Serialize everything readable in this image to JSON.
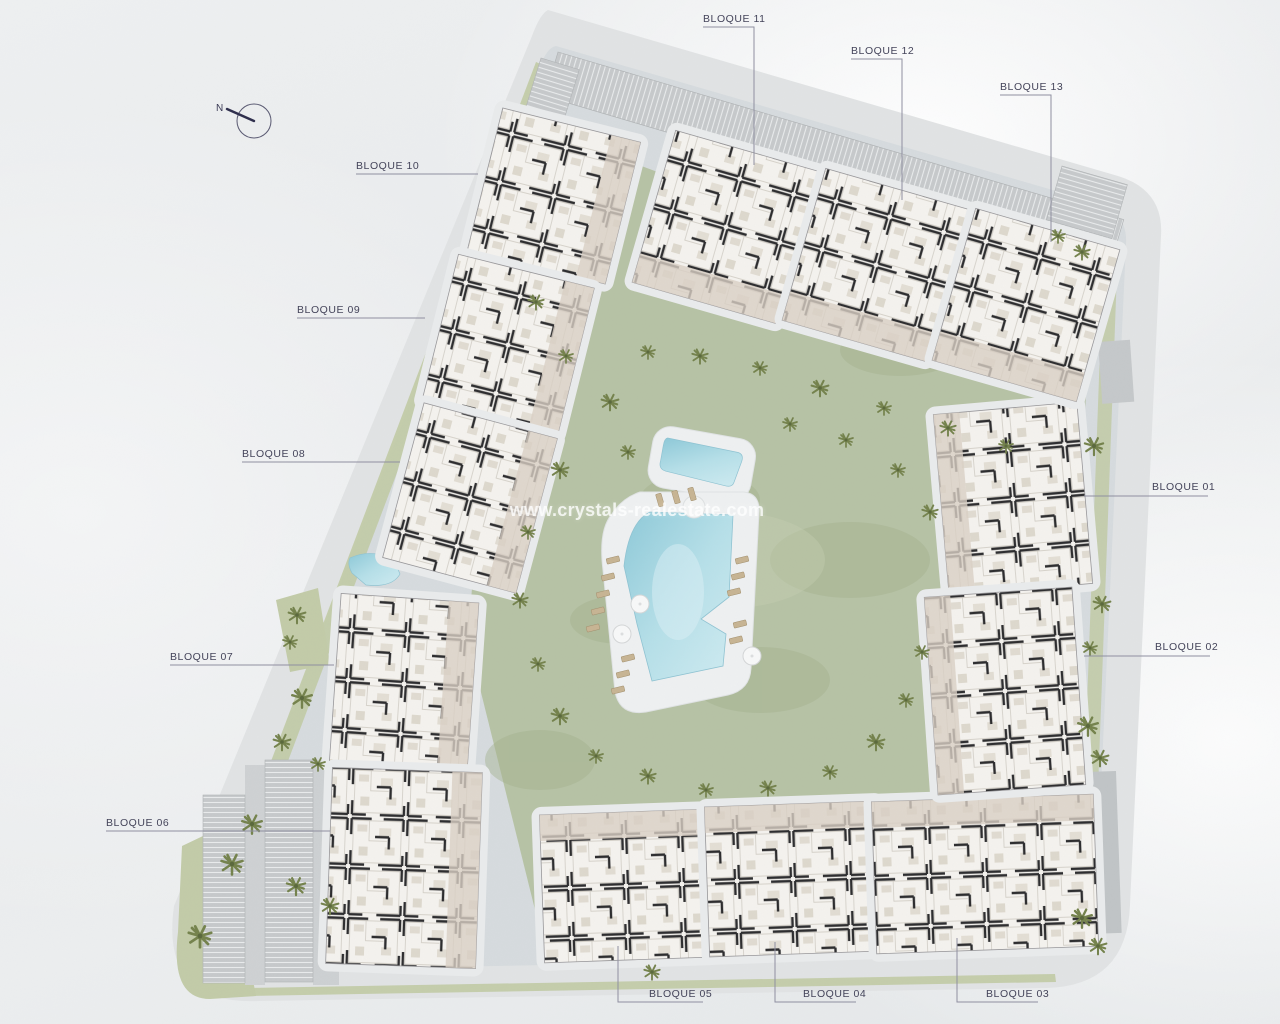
{
  "compass": {
    "label": "N"
  },
  "watermark": {
    "text": "www.crystals-realestate.com"
  },
  "blocks": [
    {
      "id": "bloque-01",
      "label": "BLOQUE 01"
    },
    {
      "id": "bloque-02",
      "label": "BLOQUE 02"
    },
    {
      "id": "bloque-03",
      "label": "BLOQUE 03"
    },
    {
      "id": "bloque-04",
      "label": "BLOQUE 04"
    },
    {
      "id": "bloque-05",
      "label": "BLOQUE 05"
    },
    {
      "id": "bloque-06",
      "label": "BLOQUE 06"
    },
    {
      "id": "bloque-07",
      "label": "BLOQUE 07"
    },
    {
      "id": "bloque-08",
      "label": "BLOQUE 08"
    },
    {
      "id": "bloque-09",
      "label": "BLOQUE 09"
    },
    {
      "id": "bloque-10",
      "label": "BLOQUE 10"
    },
    {
      "id": "bloque-11",
      "label": "BLOQUE 11"
    },
    {
      "id": "bloque-12",
      "label": "BLOQUE 12"
    },
    {
      "id": "bloque-13",
      "label": "BLOQUE 13"
    }
  ],
  "colors": {
    "site": "#e1e3e4",
    "ground": "#d6dbde",
    "lawn": "#b6c2a5",
    "verge": "#c2cba8",
    "water": "#a9d5e0",
    "building": "#f4f2ee",
    "wall": "#2c2c2e",
    "terrace": "#d9d0c4",
    "label": "#44445a",
    "leader": "#8f8fa0",
    "watermark": "#ffffff"
  }
}
